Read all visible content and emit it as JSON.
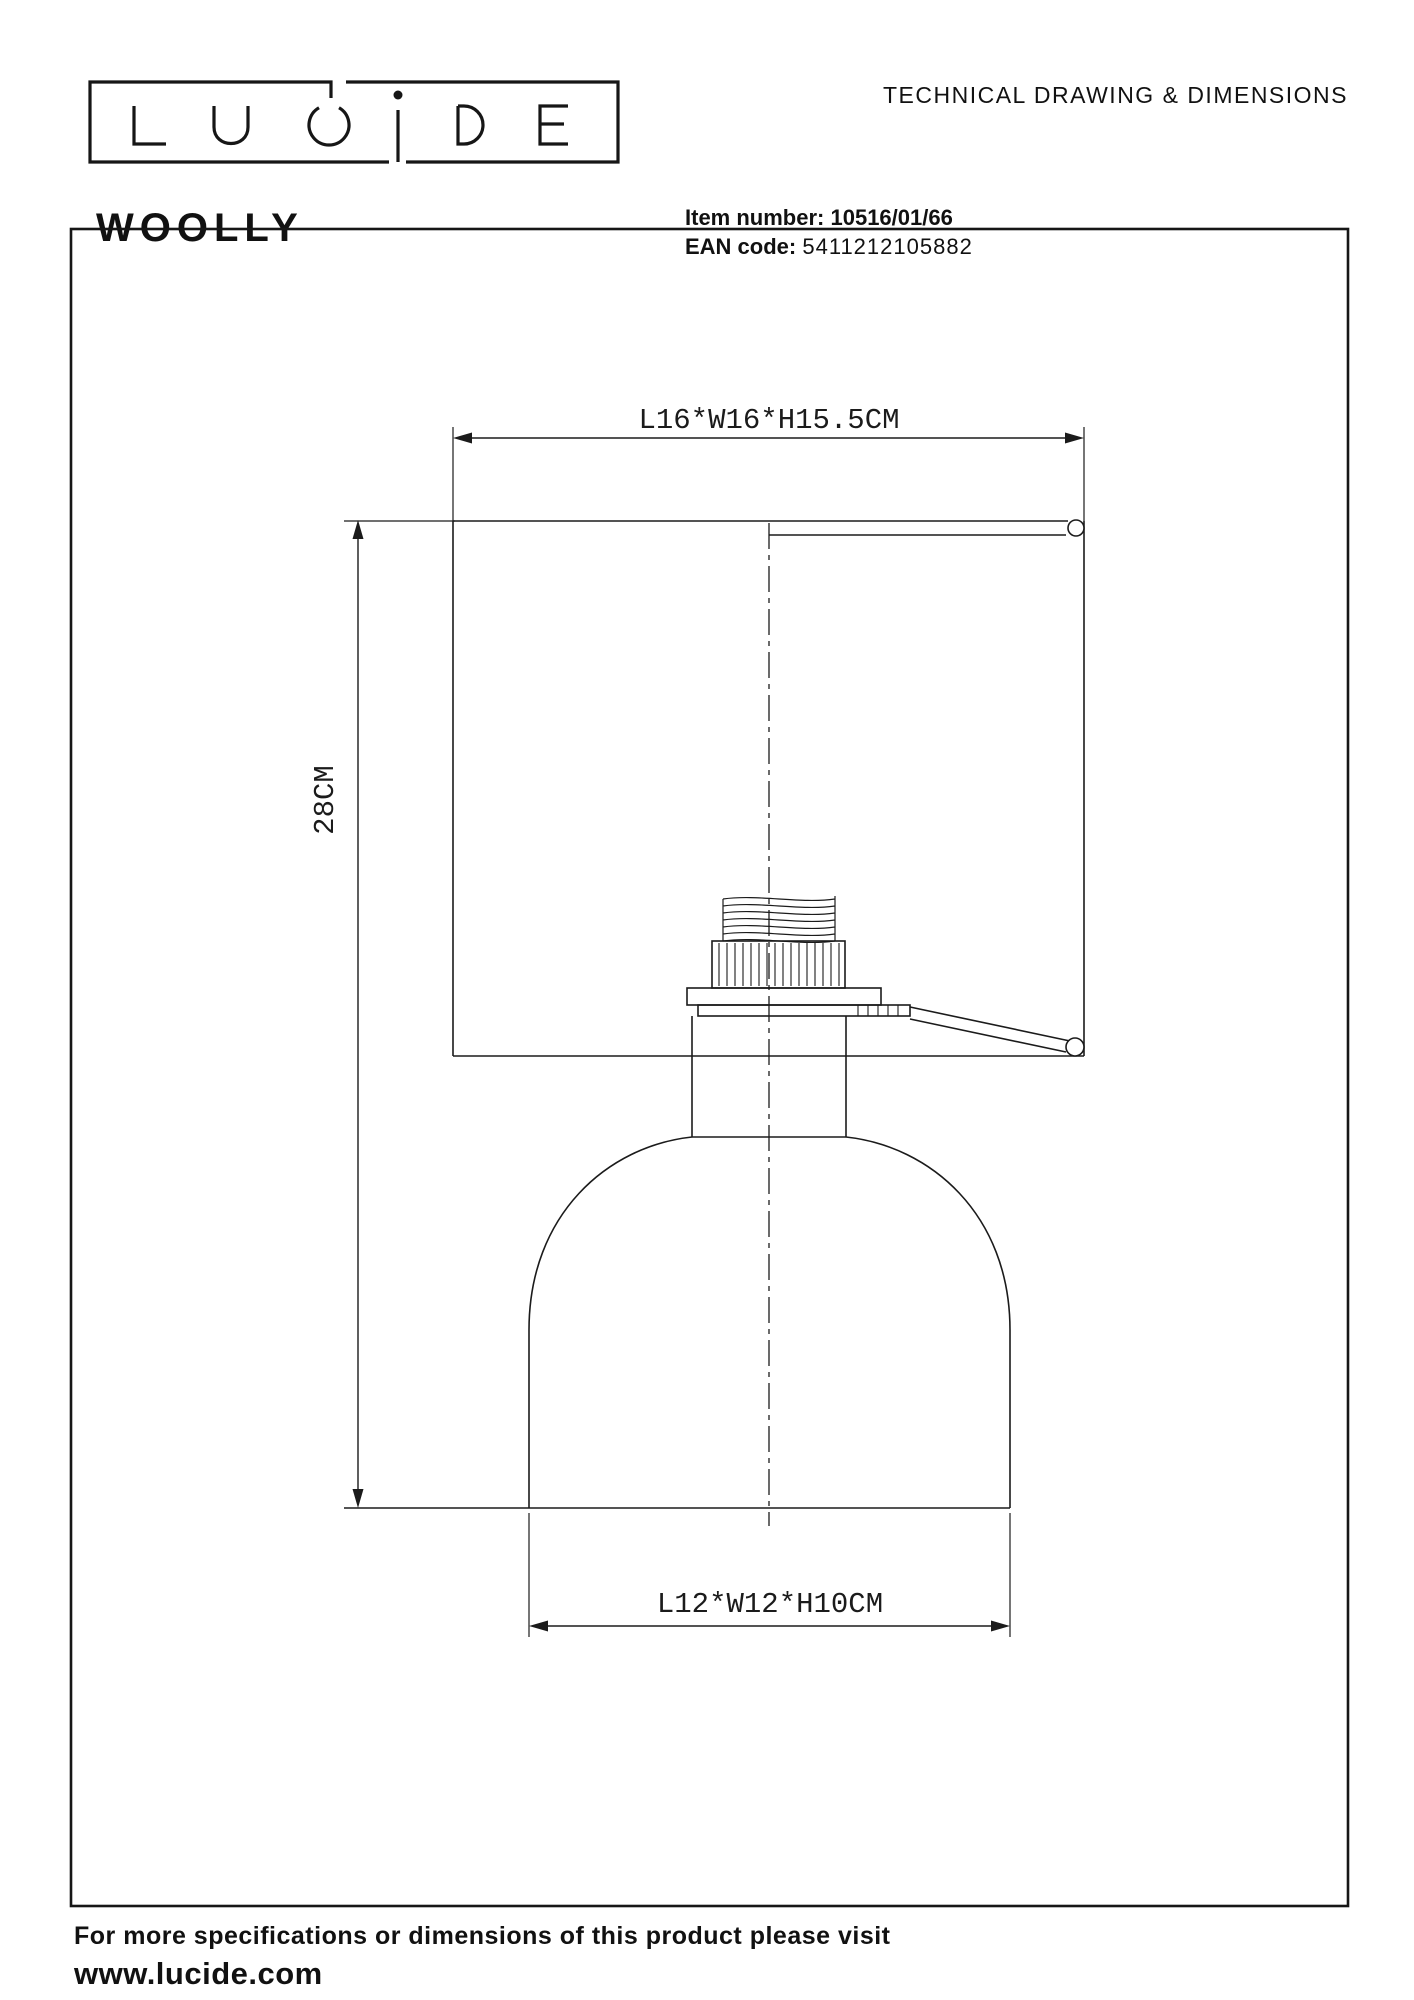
{
  "logo": {
    "text": "LUCIDE"
  },
  "header": {
    "doc_title": "TECHNICAL DRAWING & DIMENSIONS",
    "product_name": "WOOLLY",
    "item_label": "Item number:",
    "item_value": "10516/01/66",
    "ean_label": "EAN code:",
    "ean_value": "5411212105882"
  },
  "drawing": {
    "shade_dimension_label": "L16*W16*H15.5CM",
    "height_dimension_label": "28CM",
    "base_dimension_label": "L12*W12*H10CM"
  },
  "footer": {
    "note": "For more specifications or dimensions of this product please visit",
    "website": "www.lucide.com"
  },
  "colors": {
    "line": "#1b1b1b",
    "text": "#111111",
    "background": "#ffffff"
  }
}
